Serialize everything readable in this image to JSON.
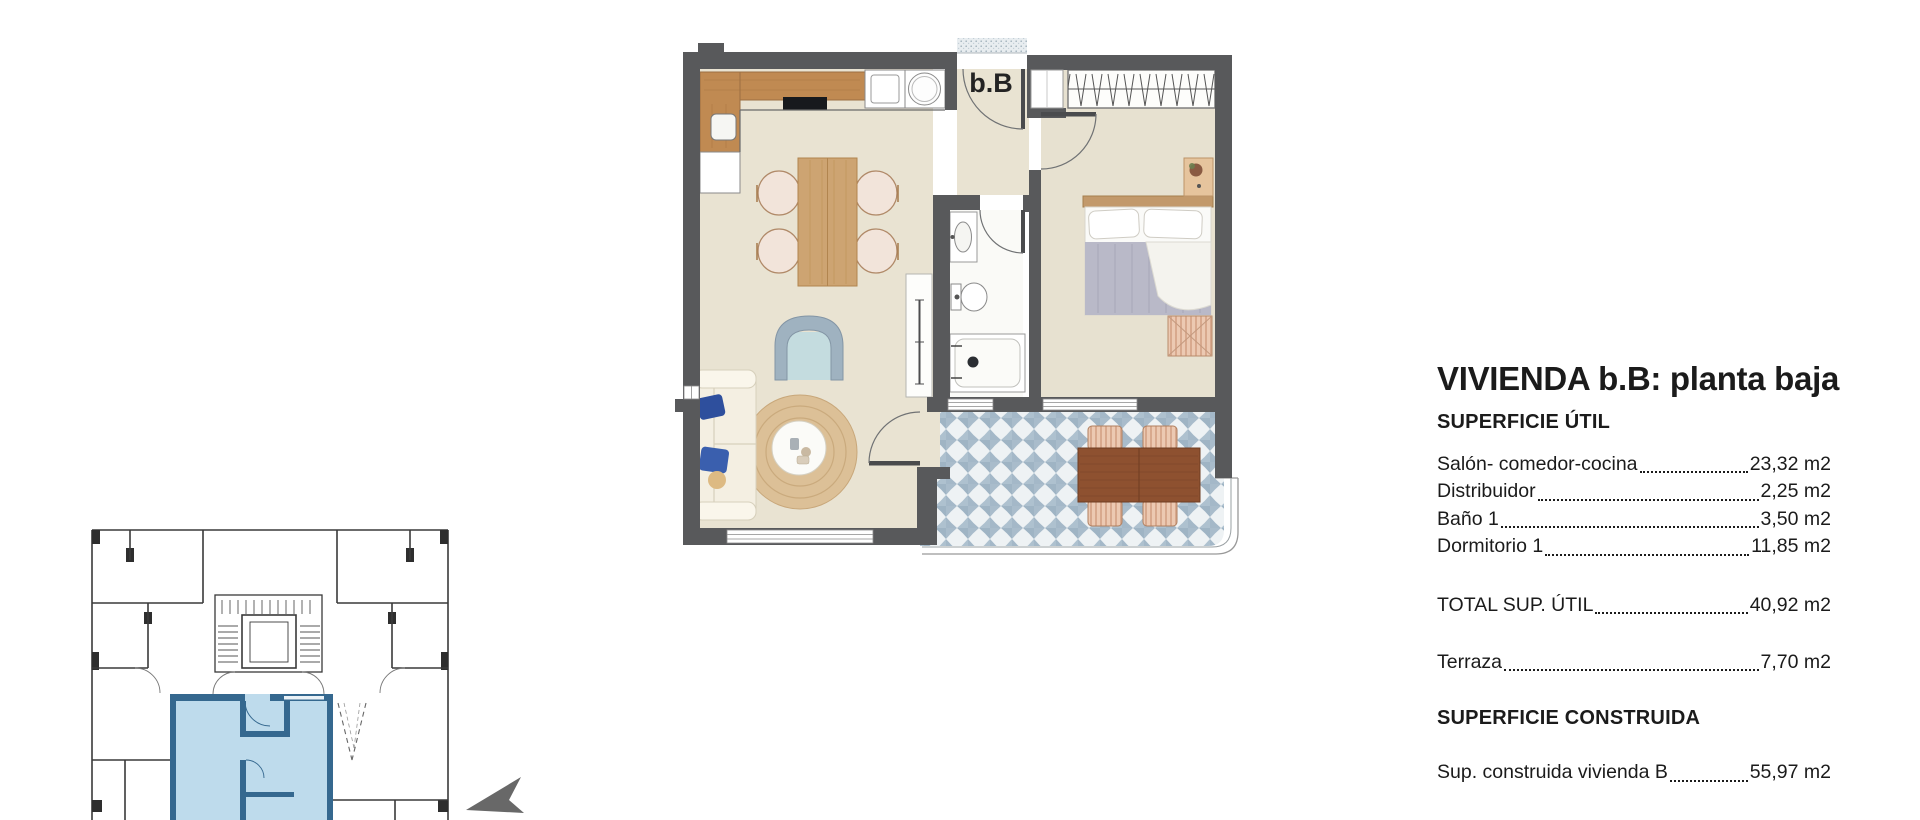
{
  "panel": {
    "title": "VIVIENDA b.B: planta baja",
    "section_util": "SUPERFICIE ÚTIL",
    "util_rows": [
      {
        "label": "Salón- comedor-cocina",
        "value": "23,32 m2"
      },
      {
        "label": "Distribuidor",
        "value": "2,25 m2"
      },
      {
        "label": "Baño 1",
        "value": "3,50 m2"
      },
      {
        "label": "Dormitorio 1",
        "value": "11,85 m2"
      }
    ],
    "total_row": {
      "label": "TOTAL SUP. ÚTIL",
      "value": "40,92 m2"
    },
    "terrace_row": {
      "label": "Terraza",
      "value": "7,70 m2"
    },
    "section_construida": "SUPERFICIE CONSTRUIDA",
    "construida_row": {
      "label": "Sup. construida vivienda B",
      "value": "55,97 m2"
    }
  },
  "plan": {
    "unit_label": "b.B",
    "colors": {
      "wall": "#58595b",
      "floor": "#e9e3d2",
      "bath_floor": "#fafaf7",
      "terrace_blue": "#a9bccb",
      "counter_wood": "#c08a52",
      "dining_wood": "#cda472",
      "outdoor_wood": "#8e5130",
      "rug": "#dcc097",
      "keyplan_highlight": "#b9d8ea",
      "keyplan_highlight_wall": "#35688f"
    }
  }
}
